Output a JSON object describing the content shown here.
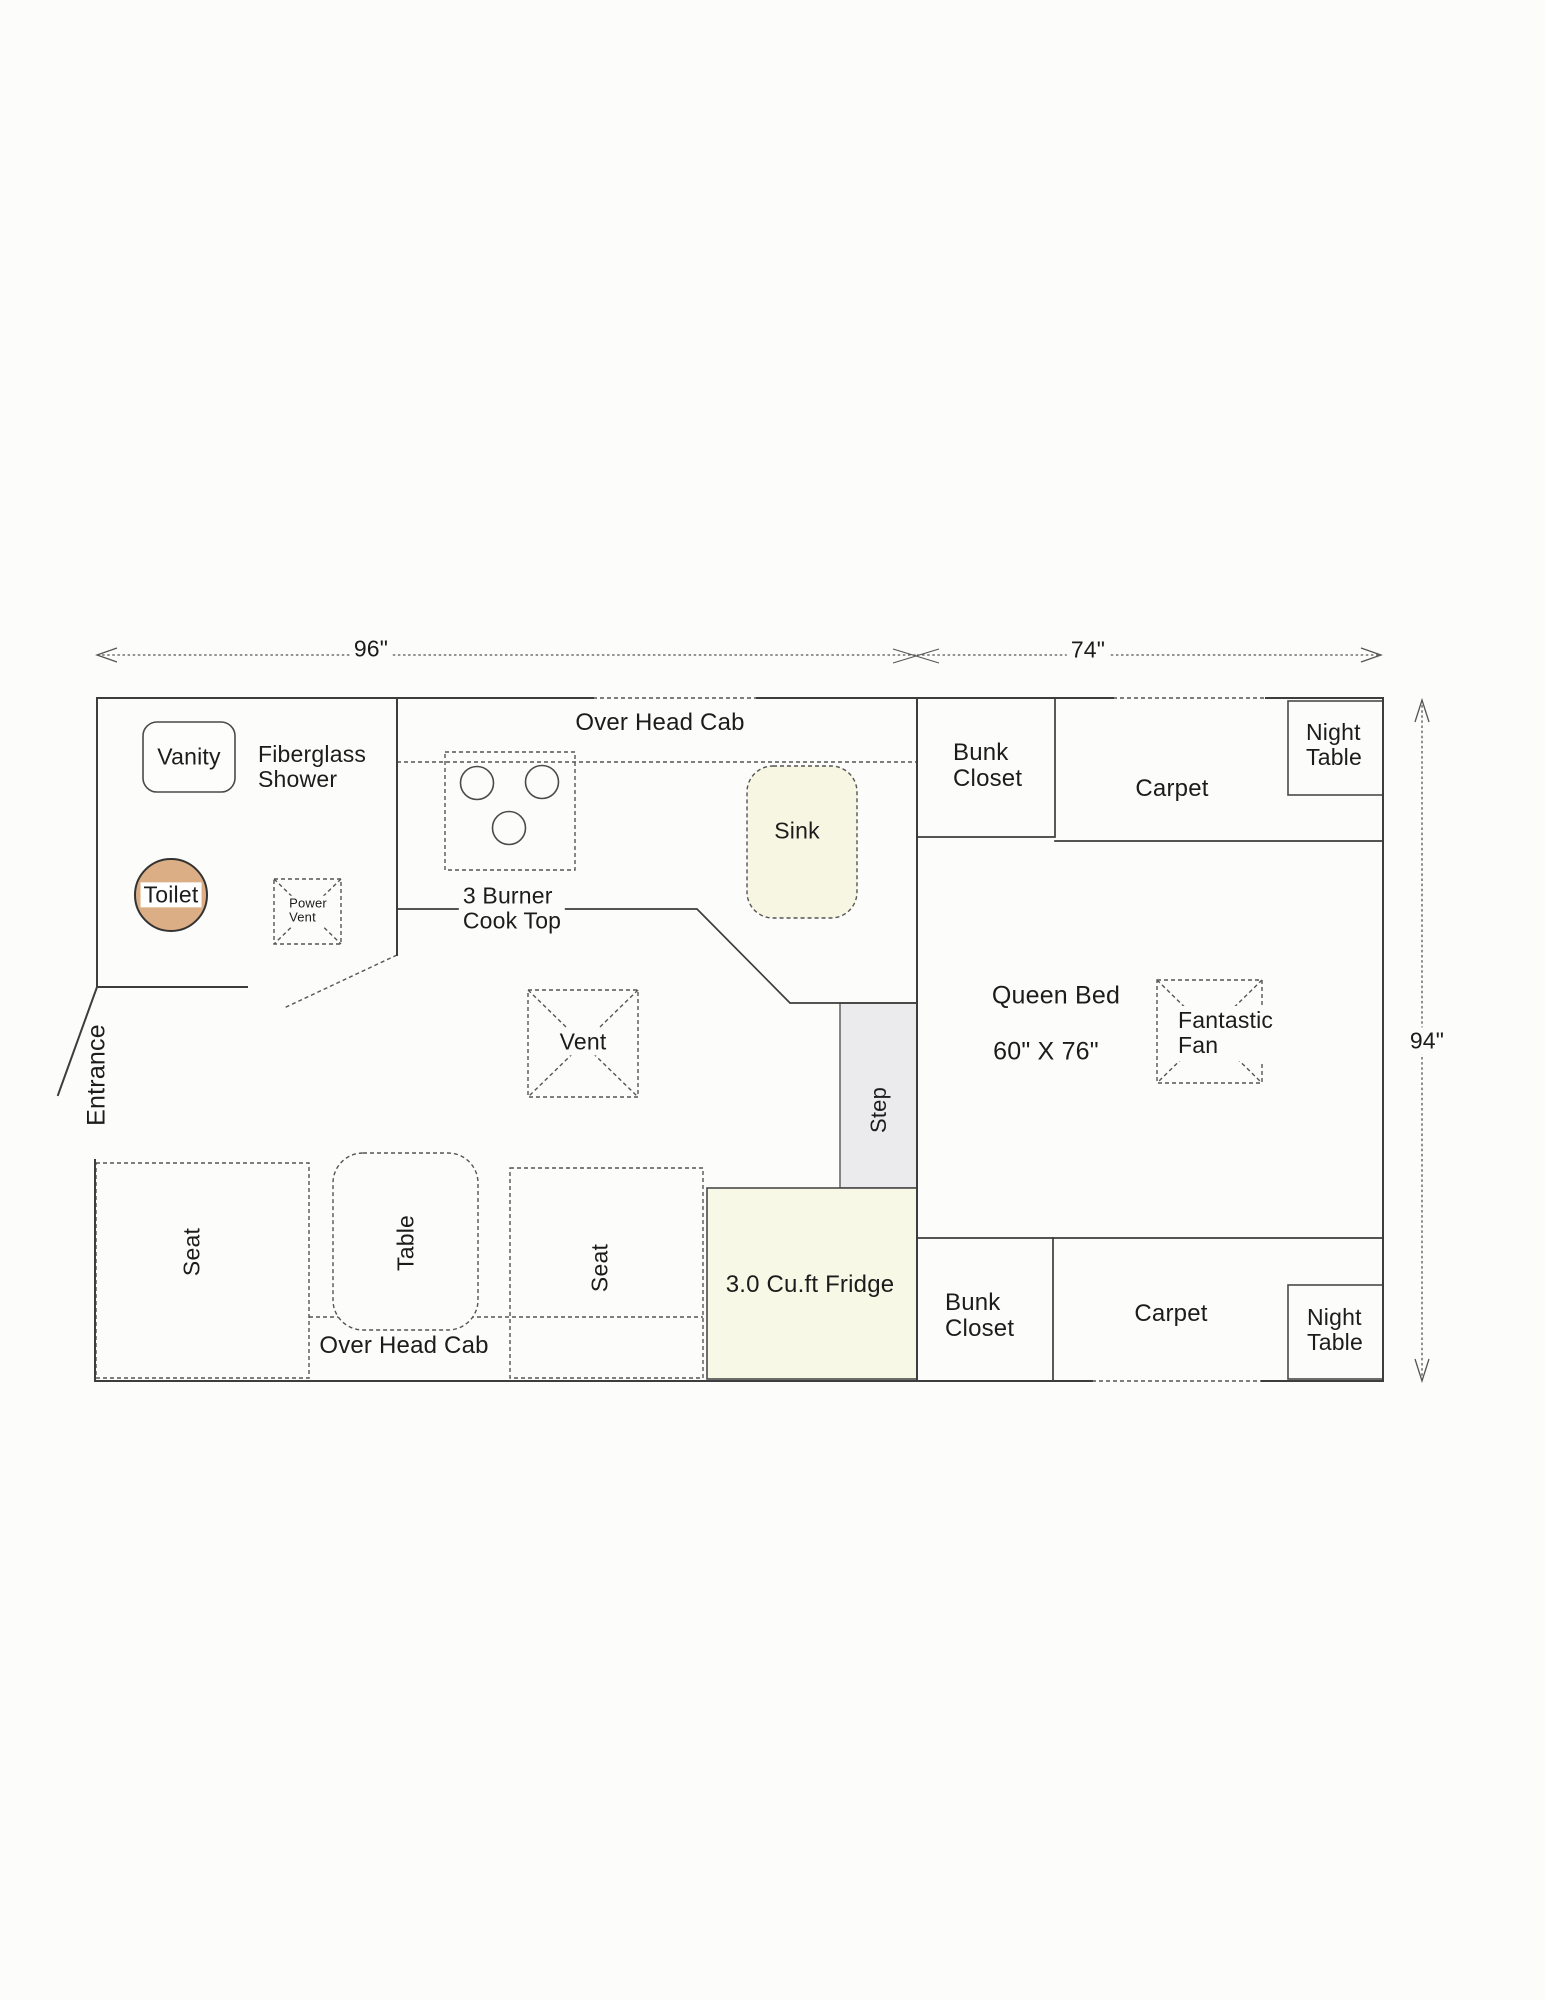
{
  "colors": {
    "background": "#fcfcfa",
    "wall_line": "#3d3d3d",
    "dashed_line": "#555555",
    "toilet_fill": "#dcae85",
    "sink_fill": "#f6f6e2",
    "fridge_fill": "#f8f8e6",
    "step_fill": "#ebebee"
  },
  "dimensions": {
    "left_width": "96\"",
    "right_width": "74\"",
    "height": "94\""
  },
  "bathroom": {
    "vanity_label": "Vanity",
    "shower_label": "Fiberglass\nShower",
    "toilet_label": "Toilet",
    "power_vent_label": "Power\nVent",
    "entrance_label": "Entrance"
  },
  "kitchen": {
    "overhead_cab_label": "Over Head Cab",
    "cooktop_label": "3 Burner\nCook Top",
    "sink_label": "Sink",
    "vent_label": "Vent",
    "step_label": "Step",
    "fridge_label": "3.0 Cu.ft Fridge"
  },
  "dinette": {
    "seat_left_label": "Seat",
    "table_label": "Table",
    "seat_right_label": "Seat",
    "overhead_cab_label": "Over Head Cab"
  },
  "bedroom": {
    "bunk_closet_top_label": "Bunk\nCloset",
    "carpet_top_label": "Carpet",
    "night_table_top_label": "Night\nTable",
    "queen_bed_label": "Queen Bed",
    "queen_bed_size": "60\" X 76\"",
    "fantastic_fan_label": "Fantastic\nFan",
    "bunk_closet_bottom_label": "Bunk\nCloset",
    "carpet_bottom_label": "Carpet",
    "night_table_bottom_label": "Night\nTable"
  }
}
